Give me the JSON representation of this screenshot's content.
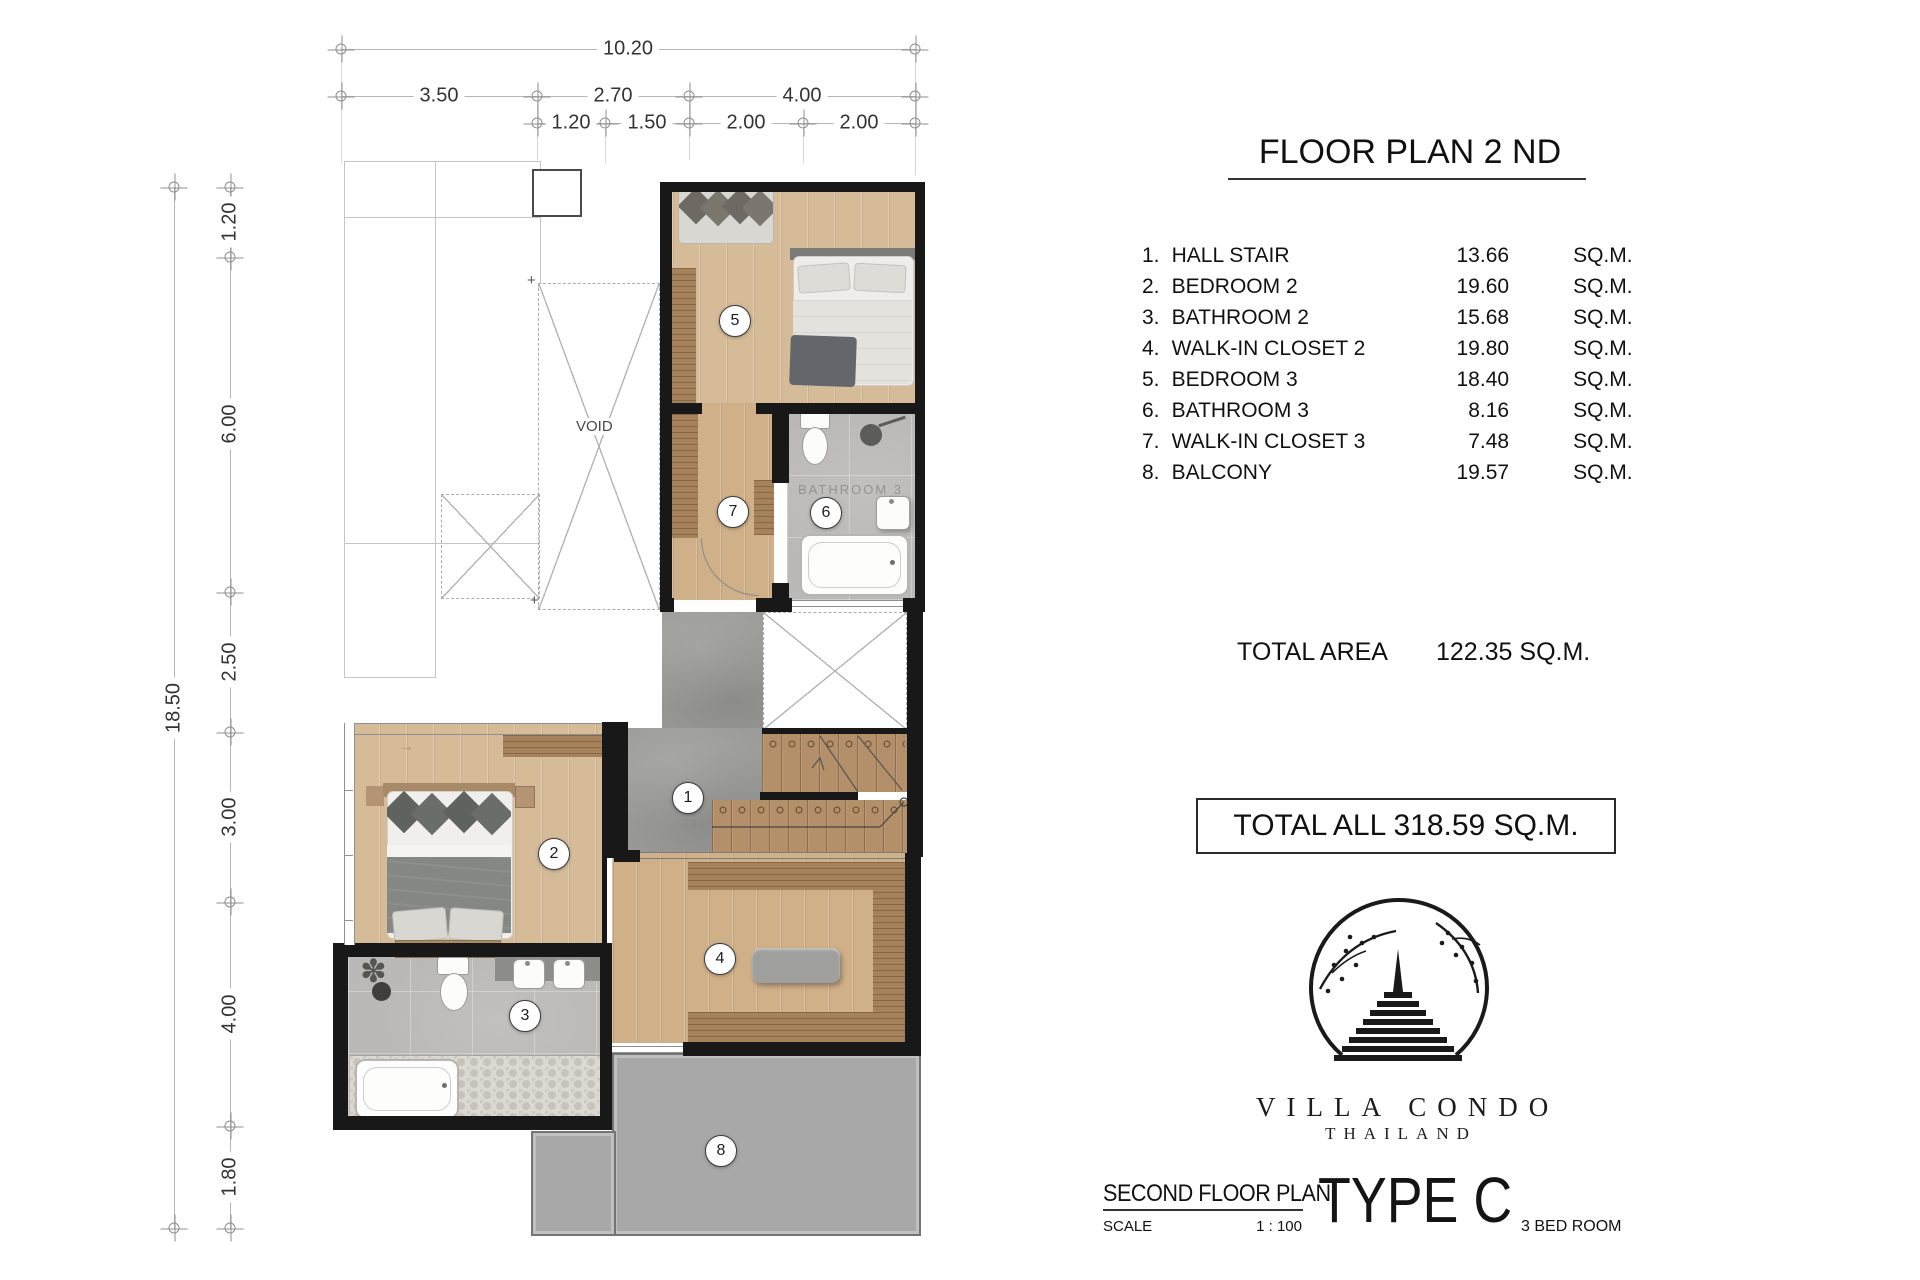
{
  "dims": {
    "top_total": "10.20",
    "top_row2": [
      "3.50",
      "2.70",
      "4.00"
    ],
    "top_row3": [
      "1.20",
      "1.50",
      "2.00",
      "2.00"
    ],
    "left_total": "18.50",
    "left_segs": [
      "1.20",
      "6.00",
      "2.50",
      "3.00",
      "4.00",
      "1.80"
    ]
  },
  "plan": {
    "void_label": "VOID",
    "dn_label": "DN",
    "bathroom3_watermark": "BATHROOM 3",
    "rooms": [
      "1",
      "2",
      "3",
      "4",
      "5",
      "6",
      "7",
      "8"
    ]
  },
  "icons": {
    "plus": "+",
    "plant": "✽",
    "arrow_right": "→"
  },
  "panel": {
    "title": "FLOOR PLAN 2 ND",
    "legend": [
      {
        "num": "1.",
        "name": "HALL STAIR",
        "area": "13.66",
        "unit": "SQ.M."
      },
      {
        "num": "2.",
        "name": "BEDROOM 2",
        "area": "19.60",
        "unit": "SQ.M."
      },
      {
        "num": "3.",
        "name": "BATHROOM 2",
        "area": "15.68",
        "unit": "SQ.M."
      },
      {
        "num": "4.",
        "name": "WALK-IN CLOSET 2",
        "area": "19.80",
        "unit": "SQ.M."
      },
      {
        "num": "5.",
        "name": "BEDROOM 3",
        "area": "18.40",
        "unit": "SQ.M."
      },
      {
        "num": "6.",
        "name": "BATHROOM 3",
        "area": "8.16",
        "unit": "SQ.M."
      },
      {
        "num": "7.",
        "name": "WALK-IN CLOSET 3",
        "area": "7.48",
        "unit": "SQ.M."
      },
      {
        "num": "8.",
        "name": "BALCONY",
        "area": "19.57",
        "unit": "SQ.M."
      }
    ],
    "total_area_label": "TOTAL AREA",
    "total_area_value": "122.35 SQ.M.",
    "total_all": "TOTAL ALL 318.59 SQ.M.",
    "logo": {
      "name": "VILLA CONDO",
      "sub": "THAILAND"
    },
    "footer": {
      "plan_name": "SECOND FLOOR PLAN",
      "scale_label": "SCALE",
      "scale_value": "1 : 100",
      "type_label": "TYPE C",
      "bedrooms": "3 BED ROOM"
    }
  },
  "colors": {
    "wall": "#181818",
    "wood": "#d5bb98",
    "wood_closet": "#cfb089",
    "wardrobe": "#a5825c",
    "stair_wood": "#b4906a",
    "concrete": "#9b9b99",
    "tile": "#bab9b7",
    "balcony": "#a8a8a8",
    "accent": "#1a1a1a"
  }
}
